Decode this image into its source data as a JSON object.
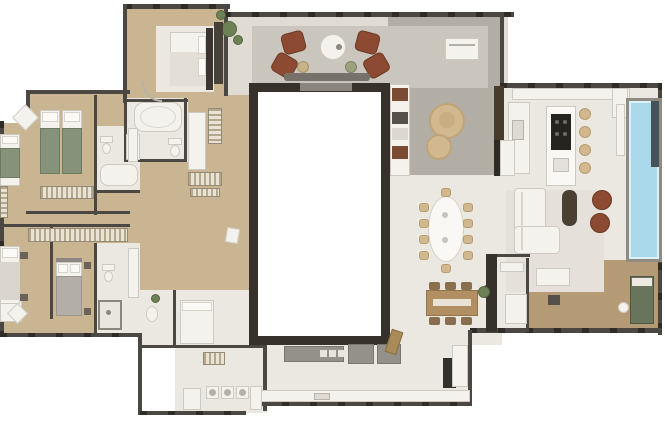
{
  "canvas": {
    "width": 665,
    "height": 427,
    "background": "#ffffff"
  },
  "palette": {
    "wall": "#4b4743",
    "wall_dark": "#2f2b27",
    "void_border": "#37312b",
    "window_gray": "#9b958c",
    "wood_floor": "#c9b592",
    "tile_floor": "#ebe8e2",
    "stone_floor": "#b3aea5",
    "rug_gray": "#cac5bd",
    "rug_light": "#e5e1da",
    "suite_rug": "#ece8e1",
    "deck_wood": "#b59a76",
    "pool_water": "#a8d8e9",
    "pool_edge": "#ddf0f6",
    "furniture_white": "#f4f2ed",
    "furniture_border": "#cfcac1",
    "marble_white": "#faf8f4",
    "leather_brown": "#8b4a31",
    "wood_furniture": "#b18f63",
    "cushion_green": "#87927a",
    "plant_green": "#6d8156",
    "dark_furniture": "#3a3530",
    "gray_cabinet": "#94908a",
    "beige_chair": "#d2b88f",
    "cooktop_black": "#26241f",
    "daybed_green": "#68755c",
    "partition_wood": "#493b2b",
    "gray_bed": "#b3afa8"
  },
  "inventory": {
    "floor_plan": "Penthouse apartment floor plan (top-down render)",
    "master_suite": "Master suite bedroom",
    "bedroom": "Bedroom",
    "twin_bedroom": "Bedroom with twin beds",
    "bathroom": "Bathroom",
    "closet": "Walk-in closet",
    "corridor": "Corridor",
    "terrace": "Covered terrace lounge",
    "fire_pit": "Round fire-pit table",
    "armchair": "Leather armchair",
    "side_table": "Side table",
    "stone_terrace": "Pebble garden terrace",
    "bench": "Garden bench",
    "lounger": "Round sun lounger",
    "outdoor_sofa": "Outdoor sofa with side tables",
    "partition": "Dark wood partition wall",
    "kitchen": "Gourmet kitchen",
    "island": "Kitchen island with cooktop",
    "stool": "Bar stool",
    "counter": "Counter with sink",
    "cabinets": "Cabinet row",
    "pool": "Swimming pool",
    "pool_ledge": "Pool ledge",
    "living": "Living room",
    "sofa": "L-shaped sofa",
    "coffee_table": "Coffee table",
    "pouf": "Leather pouf",
    "console": "TV console",
    "dining_table": "Oval dining table",
    "dining_chair": "Dining chair",
    "breakfast_table": "Breakfast table",
    "plant": "Potted plant",
    "deck": "Wood deck terrace",
    "daybed": "Outdoor daybed",
    "deck_lounger": "Deck lounger",
    "wardrobe": "Wardrobe",
    "bed": "Double bed",
    "twin_bed": "Twin bed",
    "gray_bed_item": "Bed with gray cover",
    "bathtub": "Bathtub",
    "toilet": "Toilet",
    "shower": "Shower",
    "vanity": "Vanity sink",
    "desk": "Desk with chair",
    "service": "Service / laundry area",
    "washer": "Washer-dryer unit",
    "appliance": "Oven tower",
    "door": "Door",
    "void": "Open void over lower level",
    "bridge": "Void-edge opening"
  }
}
